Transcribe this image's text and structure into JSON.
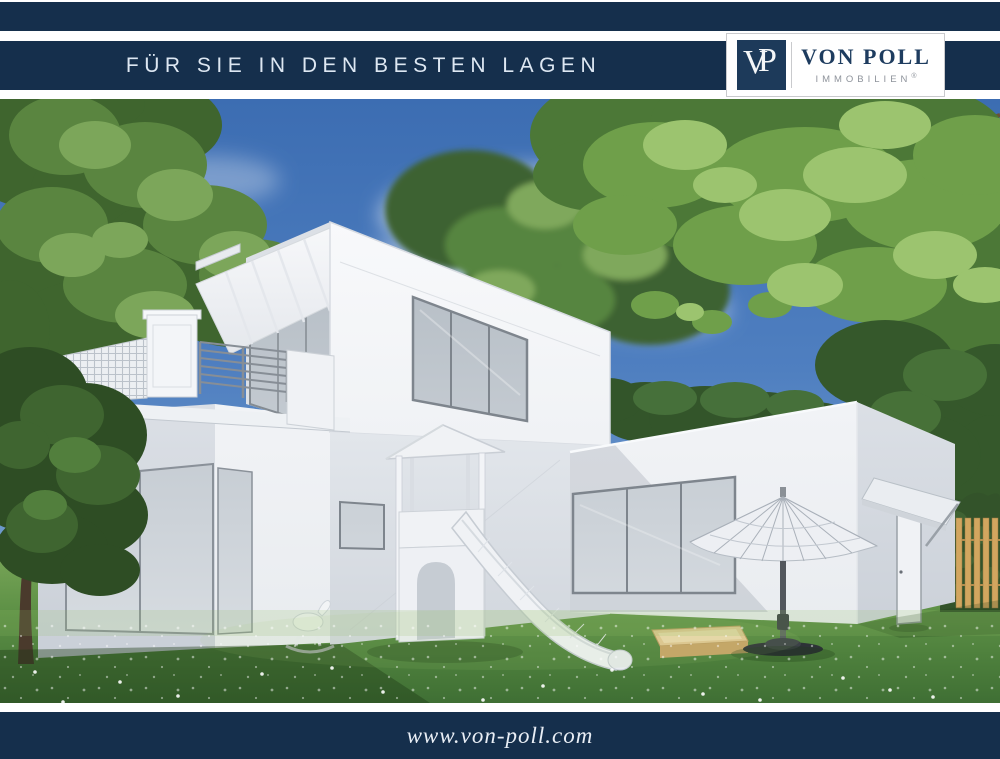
{
  "header": {
    "tagline": "FÜR SIE IN DEN BESTEN LAGEN"
  },
  "logo": {
    "monogram_v": "V",
    "monogram_p": "P",
    "name": "VON POLL",
    "subtitle": "IMMOBILIEN",
    "registered": "®"
  },
  "footer": {
    "url": "www.von-poll.com"
  },
  "photo": {
    "alt": "3D-Visualisierung: modernes weißes Einfamilienhaus mit Dachterrasse, Markise, Spielturm mit Rutsche, Sonnenschirm, Sandkasten und Garten"
  },
  "colors": {
    "brand_navy": "#152f4c",
    "logo_navy": "#1d3a5a",
    "sky_blue": "#4f7fc0",
    "grass_green": "#5f9247",
    "foliage_green": "#557f3d",
    "wall_white": "#f2f4f7"
  }
}
